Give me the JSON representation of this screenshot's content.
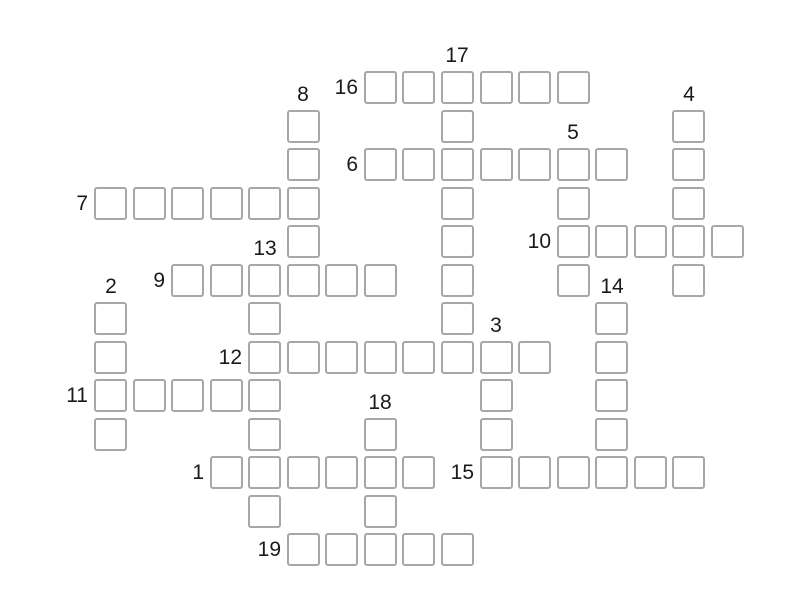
{
  "page": {
    "background_color": "#ffffff",
    "width": 800,
    "height": 600
  },
  "puzzle": {
    "type": "crossword-grid",
    "state": "empty",
    "cell_size": 33,
    "origin_x": 94,
    "origin_y": 71,
    "col_pitch": 38.55,
    "row_pitch": 38.5,
    "cell_border_color": "#a7a7a7",
    "cell_fill_color": "#ffffff",
    "label_color": "#1a1a1a",
    "clue_numbers_visible": [
      "1",
      "2",
      "3",
      "4",
      "5",
      "6",
      "7",
      "8",
      "9",
      "10",
      "11",
      "12",
      "13",
      "14",
      "15",
      "16",
      "17",
      "18",
      "19"
    ],
    "entries": [
      {
        "number": "16",
        "dir": "across",
        "col": 7,
        "row": 0,
        "len": 6
      },
      {
        "number": "17",
        "dir": "down",
        "col": 9,
        "row": 0,
        "len": 8
      },
      {
        "number": "8",
        "dir": "down",
        "col": 5,
        "row": 1,
        "len": 5
      },
      {
        "number": "4",
        "dir": "down",
        "col": 15,
        "row": 1,
        "len": 5
      },
      {
        "number": "6",
        "dir": "across",
        "col": 7,
        "row": 2,
        "len": 7
      },
      {
        "number": "5",
        "dir": "down",
        "col": 12,
        "row": 2,
        "len": 4
      },
      {
        "number": "7",
        "dir": "across",
        "col": 0,
        "row": 3,
        "len": 6
      },
      {
        "number": "10",
        "dir": "across",
        "col": 12,
        "row": 4,
        "len": 5
      },
      {
        "number": "9",
        "dir": "across",
        "col": 2,
        "row": 5,
        "len": 6
      },
      {
        "number": "13",
        "dir": "down",
        "col": 4,
        "row": 5,
        "len": 7
      },
      {
        "number": "2",
        "dir": "down",
        "col": 0,
        "row": 6,
        "len": 4
      },
      {
        "number": "14",
        "dir": "down",
        "col": 13,
        "row": 6,
        "len": 5
      },
      {
        "number": "12",
        "dir": "across",
        "col": 4,
        "row": 7,
        "len": 8
      },
      {
        "number": "3",
        "dir": "down",
        "col": 10,
        "row": 7,
        "len": 4
      },
      {
        "number": "11",
        "dir": "across",
        "col": 0,
        "row": 8,
        "len": 5
      },
      {
        "number": "18",
        "dir": "down",
        "col": 7,
        "row": 9,
        "len": 4
      },
      {
        "number": "1",
        "dir": "across",
        "col": 3,
        "row": 10,
        "len": 6
      },
      {
        "number": "15",
        "dir": "across",
        "col": 10,
        "row": 10,
        "len": 6
      },
      {
        "number": "19",
        "dir": "across",
        "col": 5,
        "row": 12,
        "len": 5
      }
    ]
  }
}
